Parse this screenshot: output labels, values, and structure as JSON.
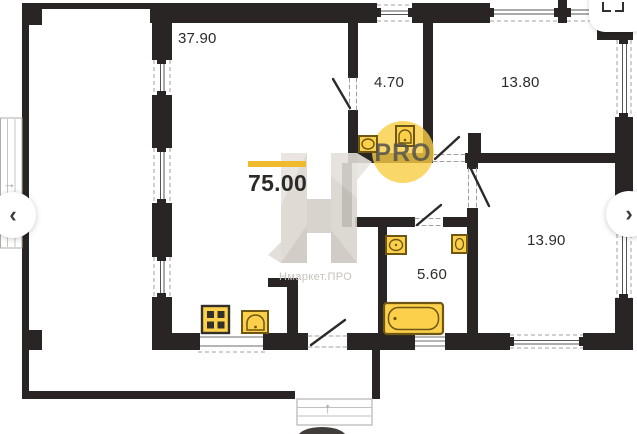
{
  "viewer": {
    "prev_icon": "‹",
    "next_icon": "›"
  },
  "floorplan": {
    "total_area": "75.00",
    "rooms": {
      "living_area": "37.90",
      "wc_area": "4.70",
      "bedroom1_area": "13.80",
      "bedroom2_area": "13.90",
      "bathroom_area": "5.60"
    },
    "symbols": {
      "entry_arrow": "→",
      "porch_arrow": "↑"
    },
    "watermark": {
      "badge": "PRO",
      "brand": "Нмаркет.ПРО"
    },
    "colors": {
      "wall": "#282524",
      "fixture_fill": "#fcd04b",
      "fixture_stroke": "#6e5712",
      "accent_bar": "#f0ba2e",
      "badge_bg": "#f9cd43"
    }
  }
}
